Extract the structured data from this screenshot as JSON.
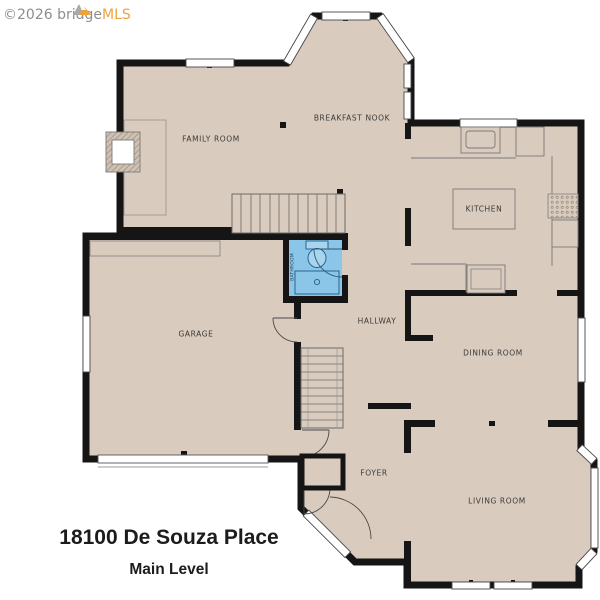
{
  "watermark": {
    "text_gray": "©2026 bridge",
    "text_orange": "MLS"
  },
  "address_title": "18100 De Souza Place",
  "level_subtitle": "Main Level",
  "rooms": [
    {
      "id": "family-room",
      "label": "FAMILY ROOM"
    },
    {
      "id": "breakfast-nook",
      "label": "BREAKFAST NOOK"
    },
    {
      "id": "kitchen",
      "label": "KITCHEN"
    },
    {
      "id": "garage",
      "label": "GARAGE"
    },
    {
      "id": "hallway",
      "label": "HALLWAY"
    },
    {
      "id": "dining-room",
      "label": "DINING ROOM"
    },
    {
      "id": "foyer",
      "label": "FOYER"
    },
    {
      "id": "living-room",
      "label": "LIVING ROOM"
    },
    {
      "id": "bathroom",
      "label": "BATHROOM"
    }
  ],
  "colors": {
    "floor": "#d9cbbd",
    "wall": "#151515",
    "bathroom_floor": "#8bc5e8",
    "watermark_gray": "#8e8e8e",
    "brand_orange": "#f0a23a",
    "label_text": "#3a3a3a"
  }
}
